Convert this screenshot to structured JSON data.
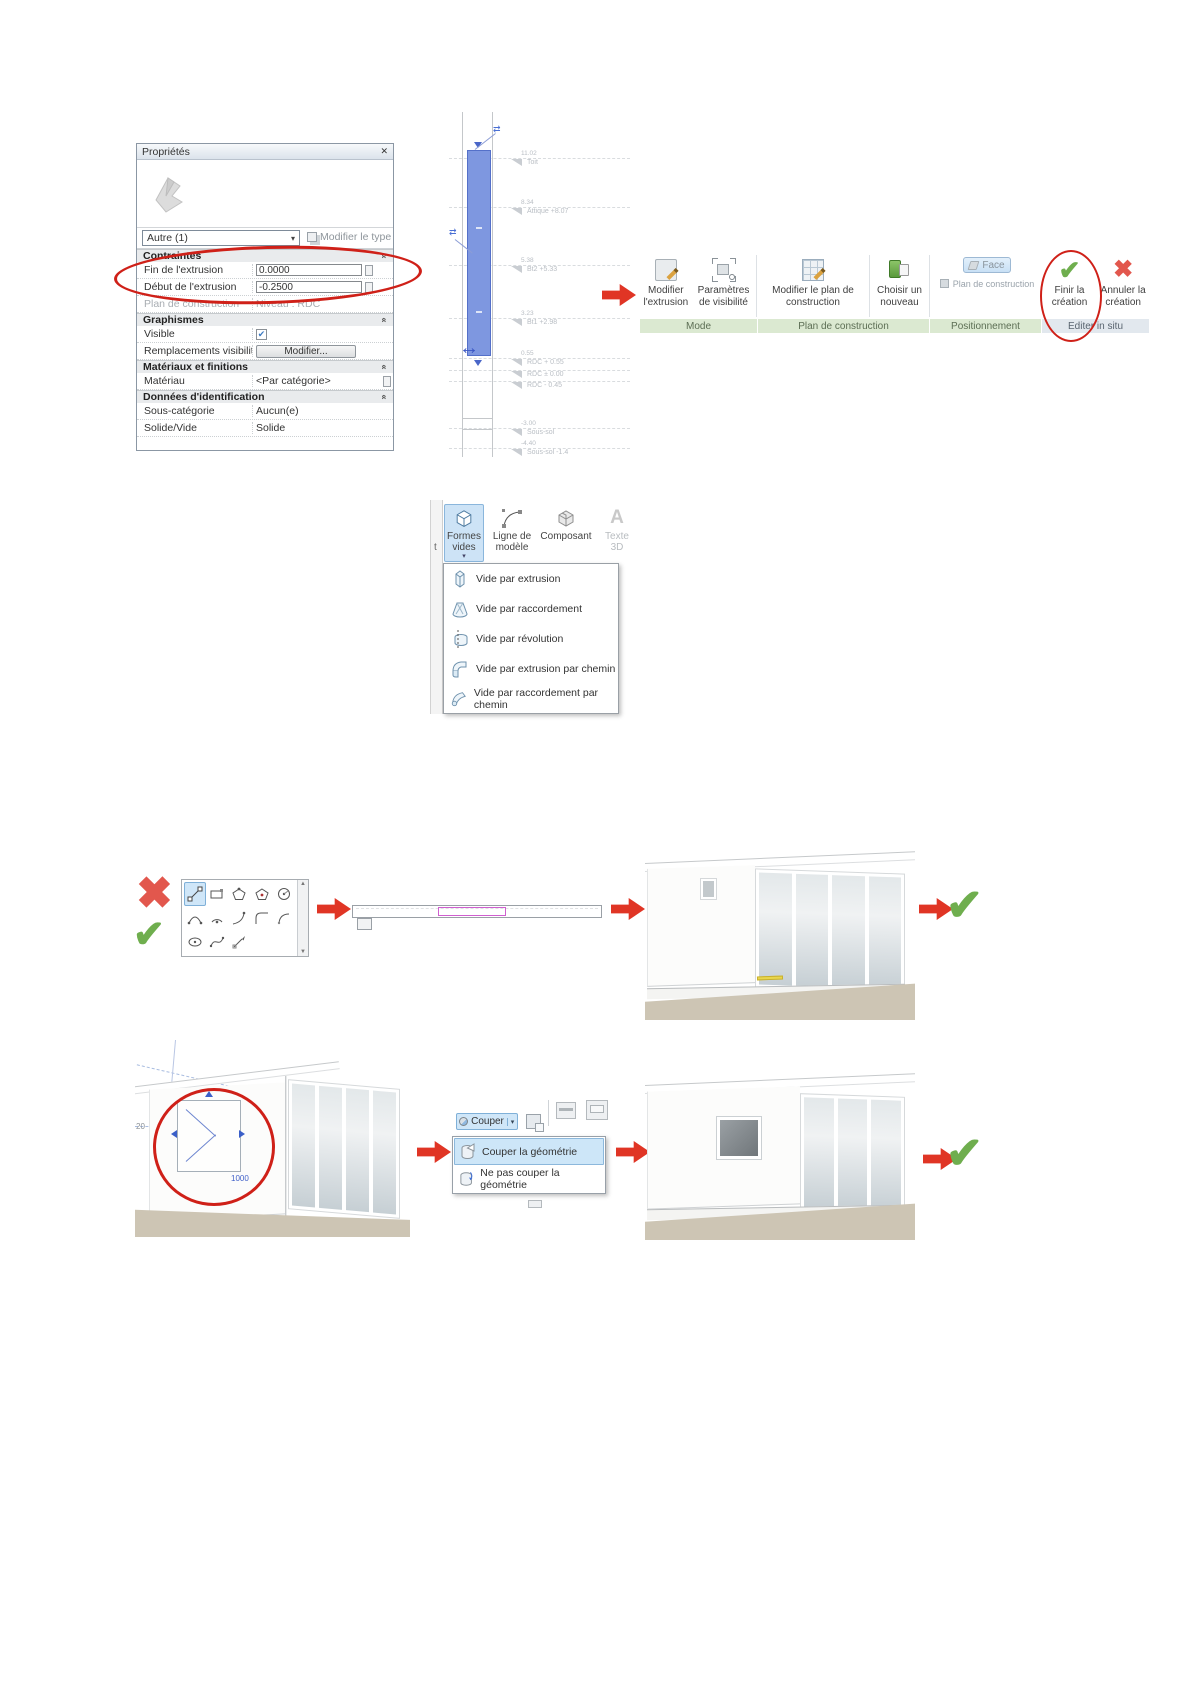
{
  "glyphs": {
    "check": "✔",
    "cross": "✖",
    "dropdown": "▾",
    "chevron": "«",
    "close": "✕",
    "flip": "⇄",
    "stretch": "↔",
    "scroll_up": "▲",
    "scroll_down": "▼"
  },
  "properties_panel": {
    "title": "Propriétés",
    "type_selector": "Autre (1)",
    "modify_type_button": "Modifier le type",
    "sections": {
      "contraintes": {
        "label": "Contraintes",
        "fin_extrusion": {
          "label": "Fin de l'extrusion",
          "value": "0.0000"
        },
        "debut_extrusion": {
          "label": "Début de l'extrusion",
          "value": "-0.2500"
        },
        "plan_construction": {
          "label": "Plan de construction",
          "value": "Niveau : RDC"
        }
      },
      "graphismes": {
        "label": "Graphismes",
        "visible": {
          "label": "Visible"
        },
        "remplacements": {
          "label": "Remplacements visibilité...",
          "button": "Modifier..."
        }
      },
      "materiaux": {
        "label": "Matériaux et finitions",
        "materiau": {
          "label": "Matériau",
          "value": "<Par catégorie>"
        }
      },
      "donnees": {
        "label": "Données d'identification",
        "sous_categorie": {
          "label": "Sous-catégorie",
          "value": "Aucun(e)"
        },
        "solide_vide": {
          "label": "Solide/Vide",
          "value": "Solide"
        }
      }
    }
  },
  "elevation": {
    "levels": [
      {
        "elev": "11.02",
        "name": "Toit"
      },
      {
        "elev": "8.34",
        "name": "Attique +8.07"
      },
      {
        "elev": "5.38",
        "name": "Bt2 +5.33"
      },
      {
        "elev": "3.23",
        "name": "Bt1 +2.98"
      },
      {
        "elev": "0.55",
        "name": "RDC + 0.55"
      },
      {
        "elev": "",
        "name": "RDC ± 0.00"
      },
      {
        "elev": "",
        "name": "RDC - 0.45"
      },
      {
        "elev": "-3.00",
        "name": "Sous-sol"
      },
      {
        "elev": "-4.40",
        "name": "Sous-sol -1.4"
      }
    ]
  },
  "ribbon": {
    "buttons": {
      "modifier_extrusion": "Modifier l'extrusion",
      "parametres_visibilite": "Paramètres de visibilité",
      "modifier_plan": "Modifier le plan de construction",
      "choisir_nouveau": "Choisir un nouveau",
      "face": "Face",
      "plan_construction": "Plan de construction",
      "finir": "Finir la création",
      "annuler": "Annuler la création"
    },
    "groups": [
      "Mode",
      "Plan de construction",
      "Positionnement",
      "Editer in situ"
    ]
  },
  "formes_panel": {
    "edge_fragment": "t",
    "buttons": [
      "Formes vides",
      "Ligne de modèle",
      "Composant",
      "Texte 3D"
    ],
    "menu": [
      "Vide par extrusion",
      "Vide par raccordement",
      "Vide par révolution",
      "Vide par extrusion par chemin",
      "Vide par raccordement par chemin"
    ]
  },
  "couper": {
    "button": "Couper",
    "menu": [
      "Couper la géométrie",
      "Ne pas couper la géométrie"
    ]
  },
  "sketch": {
    "dim_left": "20",
    "dim_width": "1000"
  }
}
